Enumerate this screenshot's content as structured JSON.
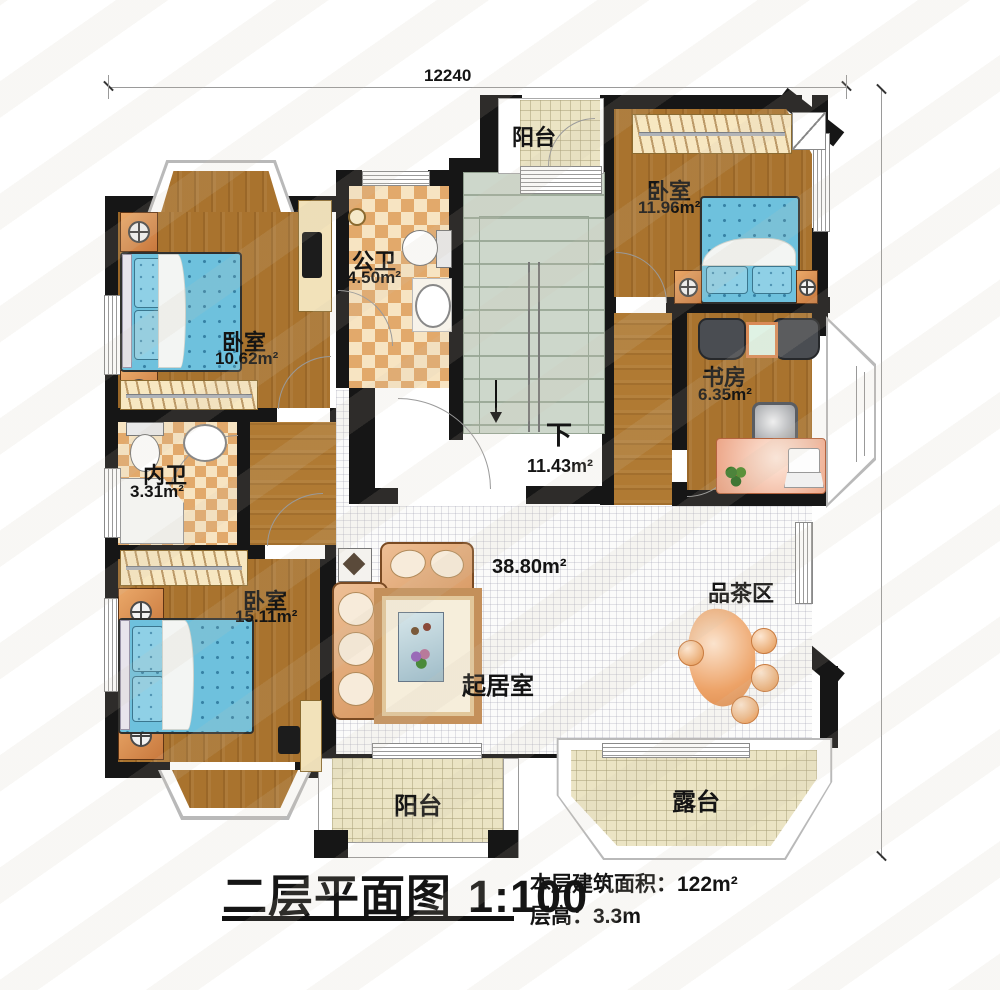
{
  "dimensions": {
    "top": "12240",
    "right": "12940"
  },
  "rooms": {
    "balcony_top": {
      "label": "阳台"
    },
    "bedroom_top_right": {
      "label": "卧室",
      "area": "11.96m²"
    },
    "public_bathroom": {
      "label": "公卫",
      "area": "4.50m²"
    },
    "bedroom_top_left": {
      "label": "卧室",
      "area": "10.62m²"
    },
    "study": {
      "label": "书房",
      "area": "6.35m²"
    },
    "inner_bathroom": {
      "label": "内卫",
      "area": "3.31m²"
    },
    "bedroom_bottom_left": {
      "label": "卧室",
      "area": "15.11m²"
    },
    "stair_hall": {
      "down_label": "下",
      "area": "11.43m²"
    },
    "living_room": {
      "label": "起居室",
      "area": "38.80m²"
    },
    "tea_area": {
      "label": "品茶区"
    },
    "balcony_bottom": {
      "label": "阳台"
    },
    "terrace": {
      "label": "露台"
    }
  },
  "title_block": {
    "title": "二层平面图",
    "scale": "1:100",
    "area_note": "本层建筑面积：122m²",
    "height_note": "层高：3.3m"
  },
  "colors": {
    "wall": "#161616",
    "wood_floor": "#a9732e",
    "bath_tile_dark": "#e2a96b",
    "bath_tile_light": "#f7e4c2",
    "bed_blue": "#6ec1dd",
    "sofa_peach": "#e8b182",
    "stair_green": "#cdd7cb",
    "balcony_tile": "#ebe4c4"
  }
}
